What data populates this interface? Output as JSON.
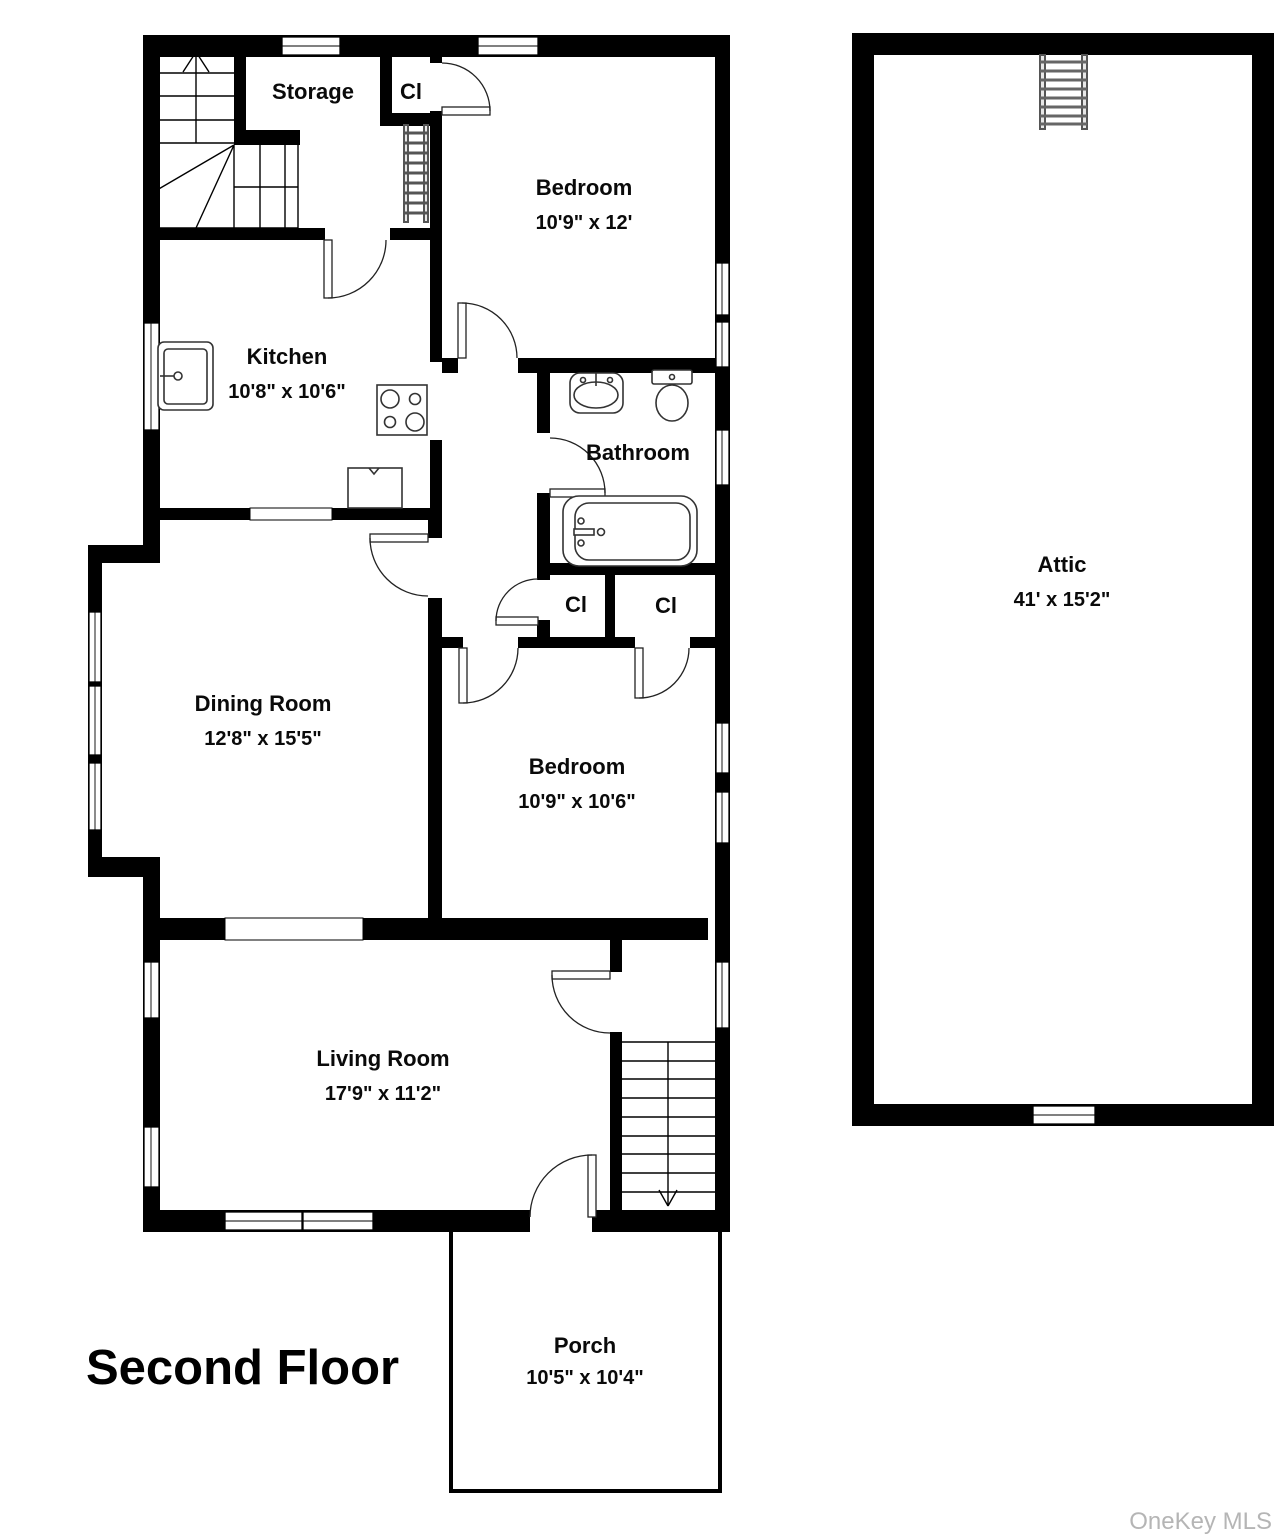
{
  "floorplan": {
    "title": "Second Floor",
    "watermark": "OneKey MLS",
    "colors": {
      "wall": "#000000",
      "background": "#ffffff",
      "watermark": "#b5b5b5"
    },
    "rooms": {
      "storage": {
        "name": "Storage"
      },
      "closet_top": {
        "name": "Cl"
      },
      "bedroom1": {
        "name": "Bedroom",
        "dims": "10'9\" x 12'"
      },
      "kitchen": {
        "name": "Kitchen",
        "dims": "10'8\" x 10'6\""
      },
      "bathroom": {
        "name": "Bathroom"
      },
      "dining_room": {
        "name": "Dining Room",
        "dims": "12'8\" x 15'5\""
      },
      "closet_hall": {
        "name": "Cl"
      },
      "closet_bedroom": {
        "name": "Cl"
      },
      "bedroom2": {
        "name": "Bedroom",
        "dims": "10'9\" x 10'6\""
      },
      "living_room": {
        "name": "Living Room",
        "dims": "17'9\" x 11'2\""
      },
      "porch": {
        "name": "Porch",
        "dims": "10'5\" x 10'4\""
      },
      "attic": {
        "name": "Attic",
        "dims": "41' x 15'2\""
      }
    }
  }
}
